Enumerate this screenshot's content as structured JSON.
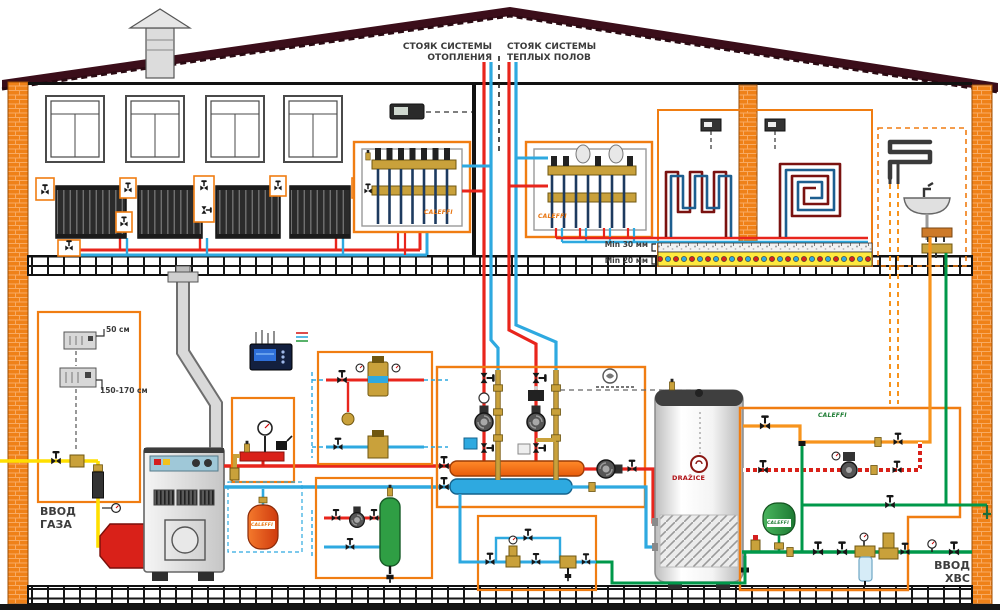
{
  "diagram": {
    "labels": {
      "riser_heating": "СТОЯК СИСТЕМЫ\nОТОПЛЕНИЯ",
      "riser_floor": "СТОЯК СИСТЕМЫ\nТЕПЛЫХ ПОЛОВ",
      "gas_inlet": "ВВОД\nГАЗА",
      "cold_water_inlet": "ВВОД\nХВС",
      "screed_min": "Min 30 мм",
      "insulation_min": "Min 20 мм",
      "gas_detector_top_height": "50 см",
      "gas_detector_bottom_height": "150-170 см"
    },
    "brands": {
      "caleffi": "CALEFFI",
      "water_heater": "DRAŽICE"
    },
    "colors": {
      "heating_supply": "#e8251c",
      "heating_return": "#2ea9e0",
      "gas_pipe": "#ffdf00",
      "cold_water": "#00984a",
      "hot_water": "#f7941d",
      "highlight_box": "#f07d12",
      "brick_wall": "#ef8118",
      "roof": "#3b0e1a",
      "floor_insulation": "#ffe93e",
      "floor_coil_supply": "#7a1210",
      "floor_coil_return": "#1d5e8f"
    }
  }
}
